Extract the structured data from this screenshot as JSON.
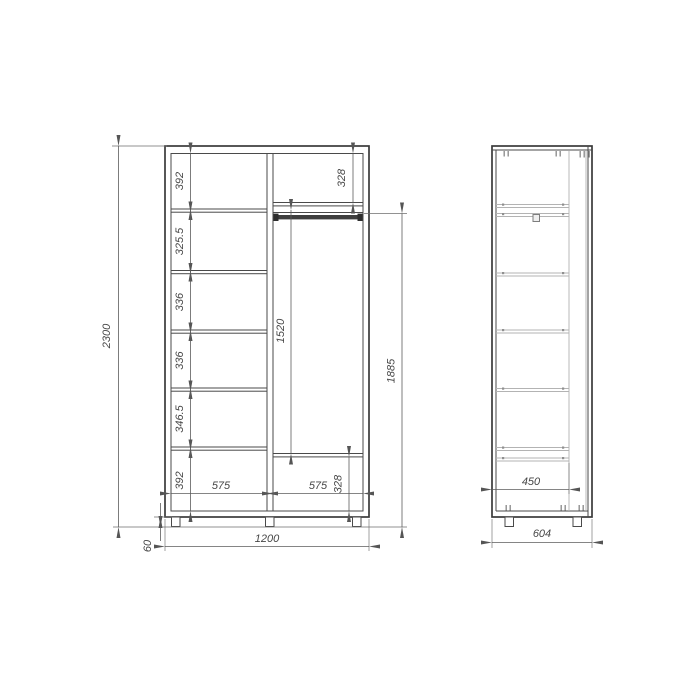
{
  "drawing_title": "wardrobe-dimension-drawing",
  "front_view": {
    "overall_height": "2300",
    "overall_width": "1200",
    "leg_height": "60",
    "left_column": {
      "width": "575",
      "section_heights": [
        "392",
        "325.5",
        "336",
        "336",
        "346.5",
        "392"
      ]
    },
    "right_column": {
      "width": "575",
      "top_section_height": "328",
      "bottom_section_height": "328",
      "hanging_space_height": "1520",
      "interior_height": "1885"
    }
  },
  "side_view": {
    "carcass_depth": "450",
    "overall_depth": "604"
  },
  "colors": {
    "background": "#ffffff",
    "main_line": "#3a3a3a",
    "dimension_line": "#5c5c5c",
    "light_line": "#b3b3b3",
    "text": "#474747"
  }
}
